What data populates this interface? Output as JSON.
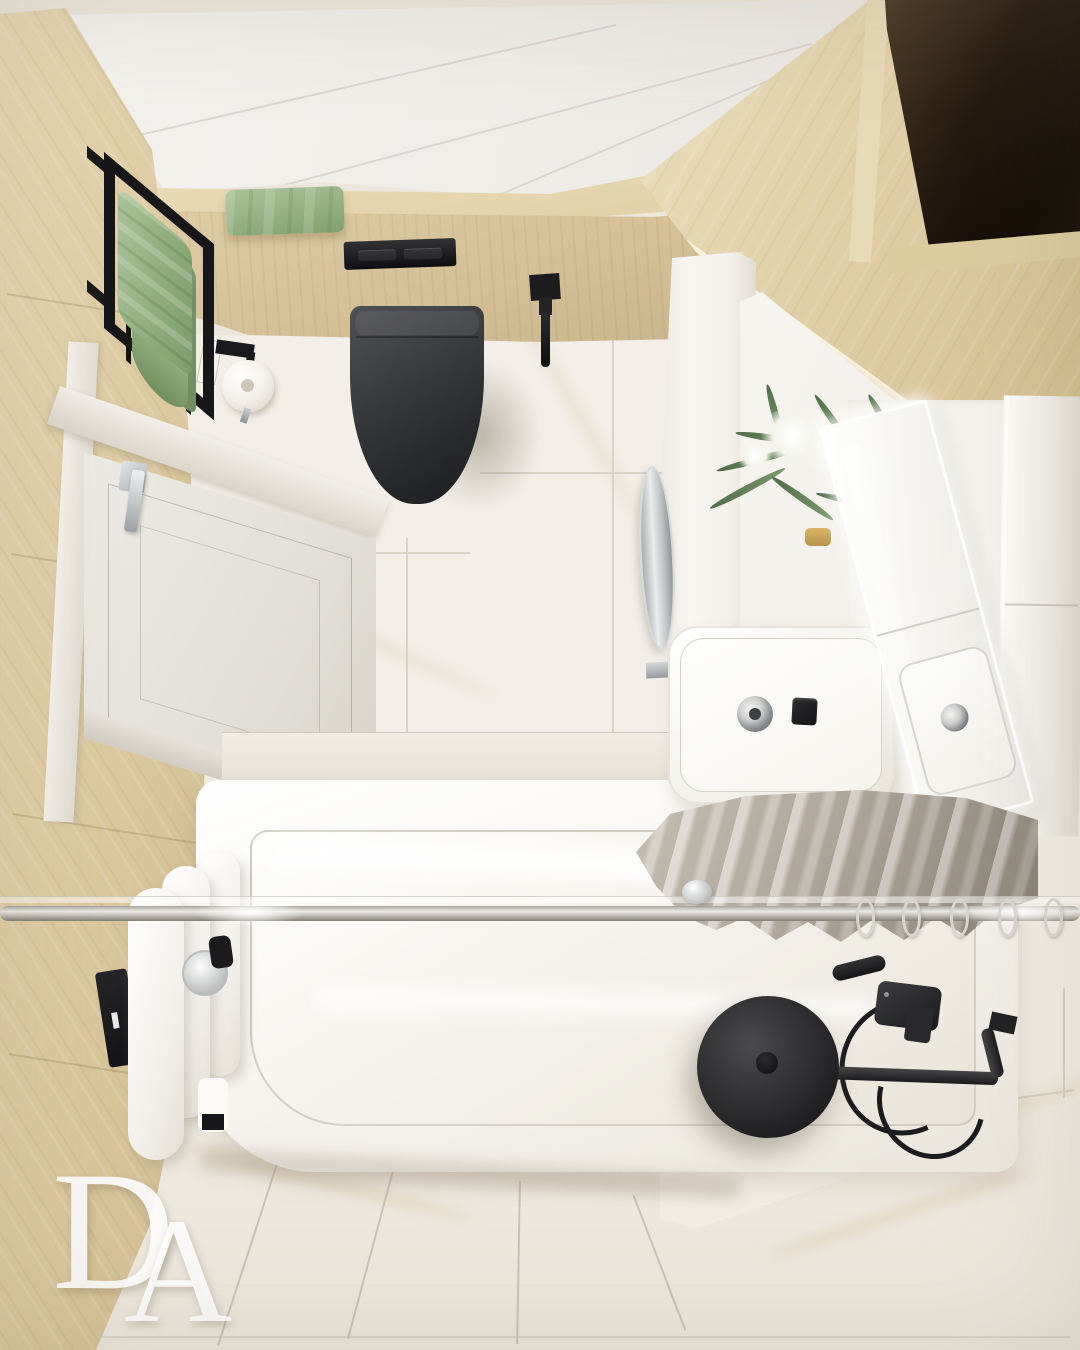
{
  "scene": {
    "room_type": "bathroom",
    "view": "top-down 3d interior render",
    "style": "modern minimal: light wood, white marble tile, matte black fixtures, sage green and taupe towels"
  },
  "logo": {
    "letter_d": "D",
    "letter_a": "A"
  },
  "palette": {
    "ceiling": "#f2f0ec",
    "wood_light": "#e9dcba",
    "wood_medium": "#d8c49c",
    "marble_wall": "#f3efe8",
    "floor": "#ece6dc",
    "grout": "#cfc9bc",
    "fixture_black": "#1d1d1f",
    "toilet_gray": "#3a3b3e",
    "cabinet_dark": "#241b11",
    "towel_green": "#96b285",
    "towel_gray": "#aba396",
    "chrome": "#cdd0d1",
    "furniture_white": "#f6f4ef",
    "plant_green": "#6d8a5f",
    "led_glow": "#ffffff"
  },
  "elements": [
    "ceiling-panels",
    "wood-ledge",
    "towel-ladder-rack",
    "green-towels",
    "flush-plate",
    "wall-hung-toilet",
    "hygienic-sprayer",
    "toilet-paper-holder",
    "light-switch",
    "entry-door",
    "door-handle",
    "round-mirror",
    "partition-wall",
    "dark-storage-cabinet",
    "wood-bulkhead",
    "vanity-counter",
    "washbasin",
    "basin-drain",
    "black-faucet",
    "led-mirror-door",
    "flower-bouquet",
    "tall-cabinet",
    "gray-towel",
    "towel-rail-rings",
    "glass-screen-rod",
    "bathtub",
    "rain-shower-head",
    "shower-mixer",
    "hand-shower-hose",
    "designer-radiator",
    "marble-floor-tiles",
    "brand-monogram"
  ]
}
